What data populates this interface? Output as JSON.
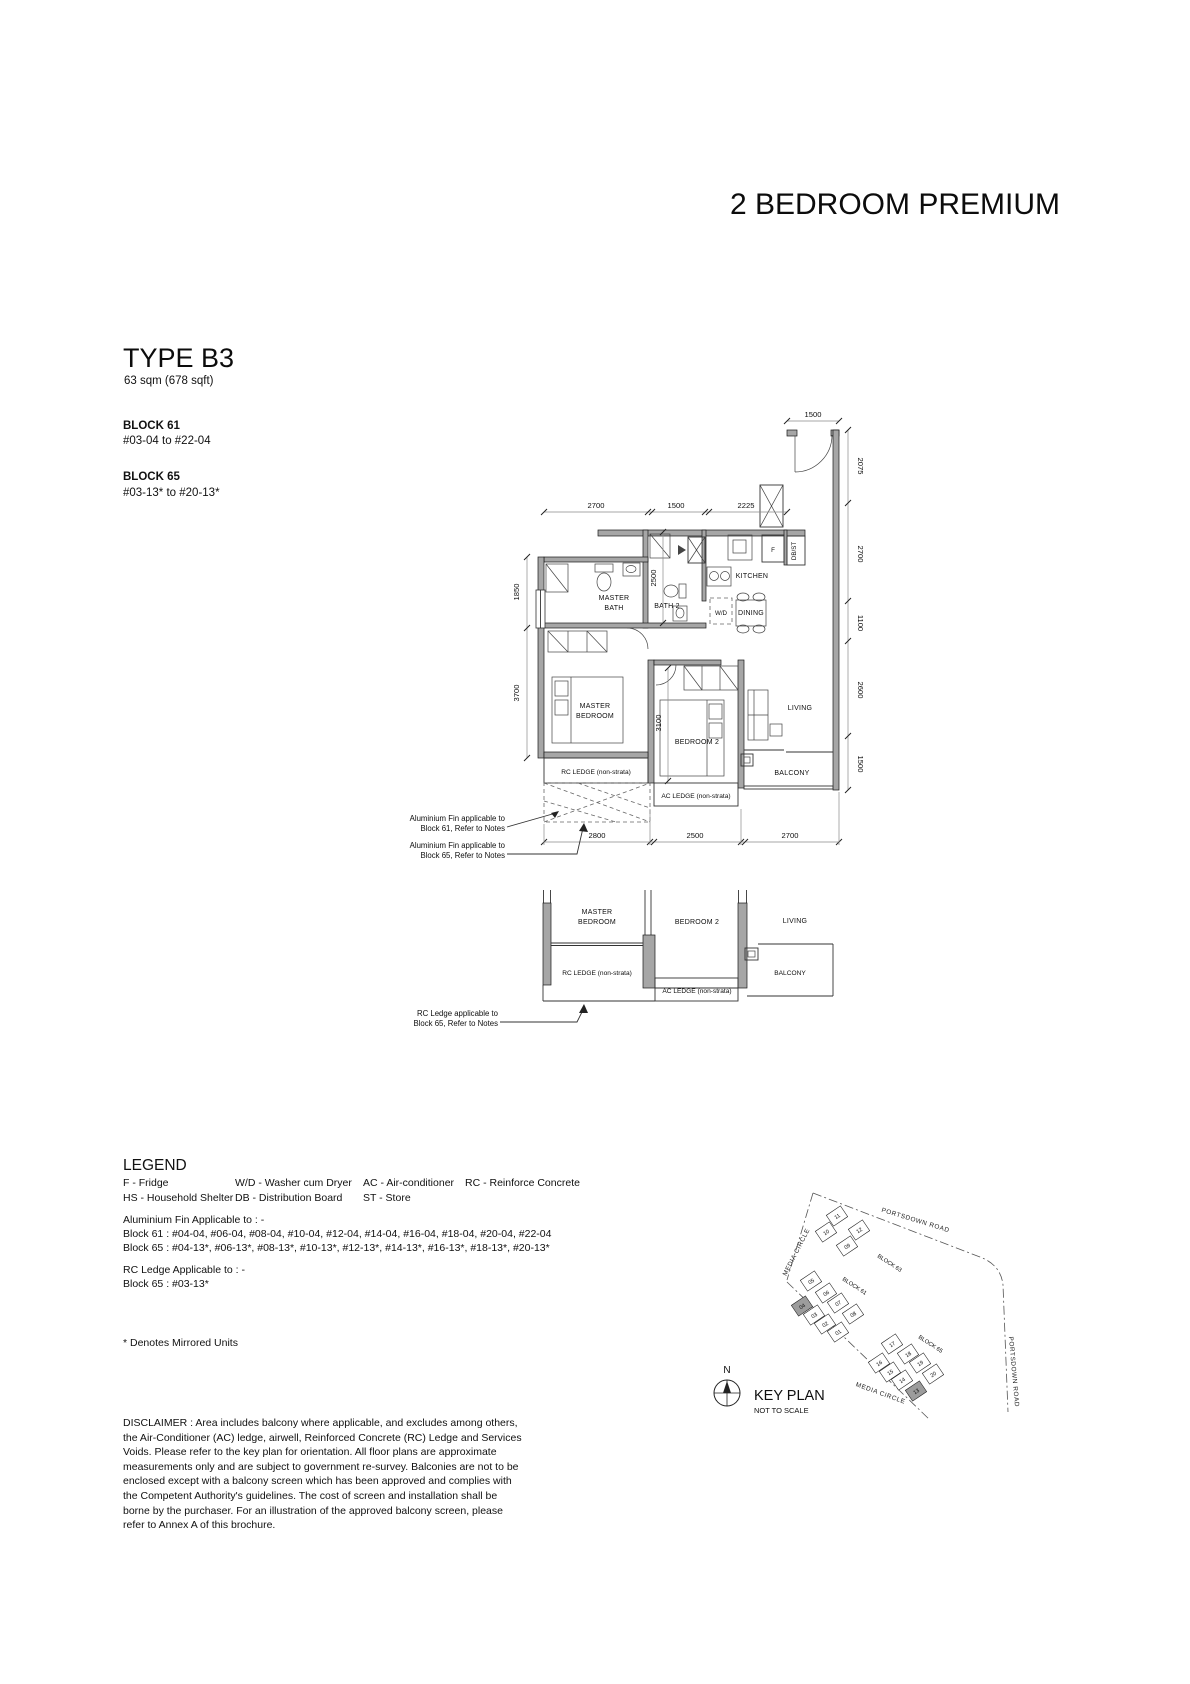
{
  "page": {
    "title": "2 BEDROOM PREMIUM"
  },
  "unit": {
    "type": "TYPE B3",
    "area": "63 sqm (678 sqft)",
    "blocks": [
      {
        "name": "BLOCK 61",
        "range": "#03-04 to #22-04"
      },
      {
        "name": "BLOCK 65",
        "range": "#03-13* to #20-13*"
      }
    ]
  },
  "plan": {
    "labels": {
      "master_bath_1": "MASTER",
      "master_bath_2": "BATH",
      "bath2": "BATH 2",
      "kitchen": "KITCHEN",
      "dining": "DINING",
      "wd": "W/D",
      "fridge": "F",
      "dbst": "DB/ST",
      "master_bedroom_1": "MASTER",
      "master_bedroom_2": "BEDROOM",
      "bedroom2": "BEDROOM 2",
      "living": "LIVING",
      "balcony": "BALCONY",
      "rc_ledge": "RC LEDGE (non-strata)",
      "ac_ledge": "AC LEDGE (non-strata)"
    },
    "dims": {
      "top": [
        "2700",
        "1500",
        "2225"
      ],
      "entry": "1500",
      "right": [
        "2075",
        "2700",
        "1100",
        "2600",
        "1500"
      ],
      "left": [
        "1850",
        "3700"
      ],
      "bottom": [
        "2800",
        "2500",
        "2700"
      ],
      "bath2_len": "2500",
      "bedroom2_len": "3100"
    },
    "annotations": {
      "alu61_1": "Aluminium Fin applicable to",
      "alu61_2": "Block 61, Refer to Notes",
      "alu65_1": "Aluminium Fin applicable to",
      "alu65_2": "Block 65, Refer to Notes",
      "rc65_1": "RC Ledge applicable to",
      "rc65_2": "Block 65, Refer to Notes"
    }
  },
  "lower_plan": {
    "master_bedroom_1": "MASTER",
    "master_bedroom_2": "BEDROOM",
    "bedroom2": "BEDROOM 2",
    "living": "LIVING",
    "rc_ledge": "RC LEDGE (non-strata)",
    "ac_ledge": "AC LEDGE (non-strata)",
    "balcony": "BALCONY"
  },
  "legend": {
    "title": "LEGEND",
    "row1": [
      "F - Fridge",
      "W/D - Washer cum Dryer",
      "AC - Air-conditioner",
      "RC - Reinforce Concrete"
    ],
    "row2": [
      "HS - Household Shelter",
      "DB - Distribution Board",
      "ST - Store"
    ],
    "alu_fin_title": "Aluminium Fin Applicable to : -",
    "alu_fin_b61": "Block 61 : #04-04, #06-04, #08-04, #10-04, #12-04, #14-04, #16-04, #18-04, #20-04, #22-04",
    "alu_fin_b65": "Block 65 : #04-13*, #06-13*, #08-13*, #10-13*, #12-13*, #14-13*, #16-13*, #18-13*, #20-13*",
    "rc_ledge_title": "RC Ledge Applicable to : -",
    "rc_ledge_b65": "Block 65 : #03-13*",
    "mirrored_note": "* Denotes Mirrored Units"
  },
  "disclaimer": "DISCLAIMER : Area includes balcony where applicable, and excludes among others, the Air-Conditioner (AC) ledge, airwell, Reinforced Concrete (RC) Ledge and Services Voids. Please refer to the key plan for orientation. All floor plans are approximate measurements only and are subject to government re-survey. Balconies are not to be enclosed except with a balcony screen which has been approved and complies with the Competent Authority's guidelines. The cost of screen and installation shall be borne by the purchaser. For an illustration of the approved balcony screen, please refer to Annex A of this brochure.",
  "keyplan": {
    "title": "KEY PLAN",
    "subtitle": "NOT TO SCALE",
    "north": "N",
    "roads": {
      "portsdown_top": "PORTSDOWN ROAD",
      "portsdown_right": "PORTSDOWN ROAD",
      "media_left": "MEDIA CIRCLE",
      "media_bottom": "MEDIA CIRCLE"
    },
    "b63": {
      "label": "BLOCK 63",
      "units": [
        "11",
        "10",
        "12",
        "09"
      ]
    },
    "b61": {
      "label": "BLOCK 61",
      "units": [
        "05",
        "06",
        "07",
        "08",
        "04",
        "03",
        "02",
        "01"
      ]
    },
    "b65": {
      "label": "BLOCK 65",
      "units": [
        "17",
        "18",
        "19",
        "20",
        "16",
        "15",
        "14",
        "13"
      ]
    },
    "highlighted_units": [
      "04",
      "13"
    ]
  }
}
